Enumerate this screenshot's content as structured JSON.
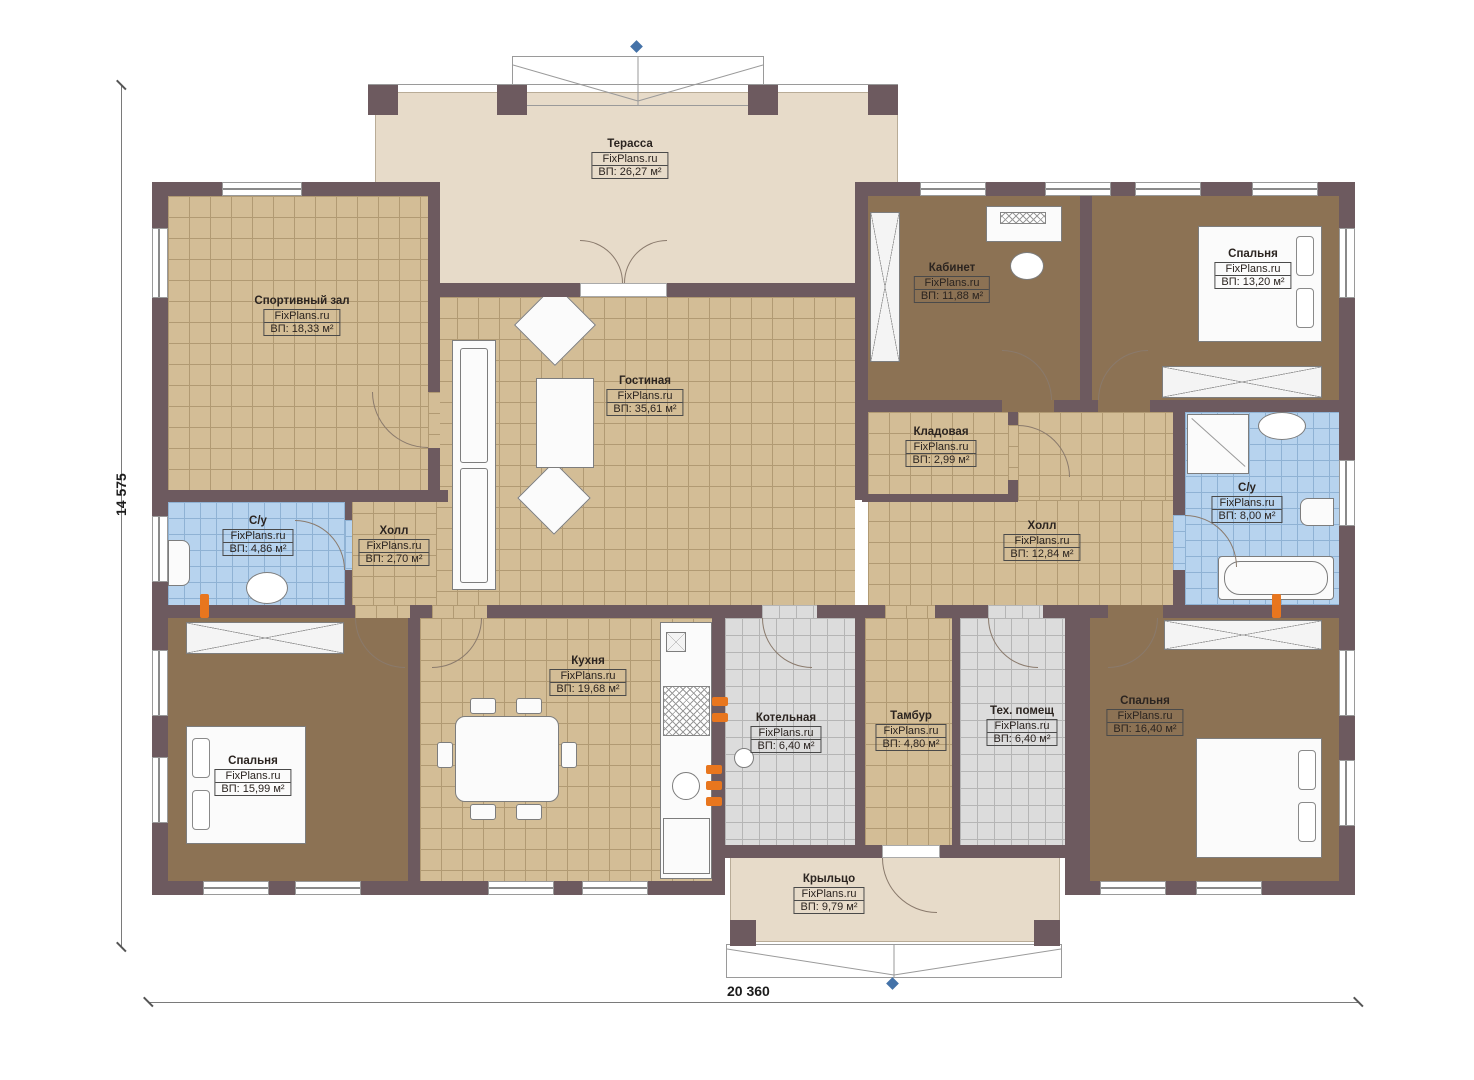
{
  "palette": {
    "wall": "#6D5A5F",
    "tan": "#D3BD96",
    "tanGrid": "#B19A73",
    "brown": "#8C7254",
    "blue": "#B7D3EE",
    "blueGrid": "#8FB2D4",
    "gray": "#DCDCDC",
    "grayGrid": "#B5B5B5",
    "beige": "#E7DBC9",
    "accent": "#E8761E",
    "marker": "#4472A8",
    "ink": "#2B2420"
  },
  "dimensions": {
    "height_label": "14 575",
    "width_label": "20 360"
  },
  "rooms": [
    {
      "id": "terrace",
      "name": "Терасса",
      "site": "FixPlans.ru",
      "area": "ВП: 26,27 м²"
    },
    {
      "id": "gym",
      "name": "Спортивный зал",
      "site": "FixPlans.ru",
      "area": "ВП: 18,33 м²"
    },
    {
      "id": "living-room",
      "name": "Гостиная",
      "site": "FixPlans.ru",
      "area": "ВП: 35,61 м²"
    },
    {
      "id": "office",
      "name": "Кабинет",
      "site": "FixPlans.ru",
      "area": "ВП: 11,88 м²"
    },
    {
      "id": "bedroom-top-right",
      "name": "Спальня",
      "site": "FixPlans.ru",
      "area": "ВП: 13,20 м²"
    },
    {
      "id": "pantry",
      "name": "Кладовая",
      "site": "FixPlans.ru",
      "area": "ВП: 2,99 м²"
    },
    {
      "id": "wc-left",
      "name": "С/у",
      "site": "FixPlans.ru",
      "area": "ВП: 4,86 м²"
    },
    {
      "id": "hall-small",
      "name": "Холл",
      "site": "FixPlans.ru",
      "area": "ВП: 2,70 м²"
    },
    {
      "id": "hall",
      "name": "Холл",
      "site": "FixPlans.ru",
      "area": "ВП: 12,84 м²"
    },
    {
      "id": "wc-right",
      "name": "С/у",
      "site": "FixPlans.ru",
      "area": "ВП: 8,00 м²"
    },
    {
      "id": "bedroom-bottom-left",
      "name": "Спальня",
      "site": "FixPlans.ru",
      "area": "ВП: 15,99 м²"
    },
    {
      "id": "kitchen",
      "name": "Кухня",
      "site": "FixPlans.ru",
      "area": "ВП: 19,68 м²"
    },
    {
      "id": "boiler-room",
      "name": "Котельная",
      "site": "FixPlans.ru",
      "area": "ВП: 6,40 м²"
    },
    {
      "id": "vestibule",
      "name": "Тамбур",
      "site": "FixPlans.ru",
      "area": "ВП: 4,80 м²"
    },
    {
      "id": "tech-room",
      "name": "Тех. помещ",
      "site": "FixPlans.ru",
      "area": "ВП: 6,40 м²"
    },
    {
      "id": "bedroom-bottom-right",
      "name": "Спальня",
      "site": "FixPlans.ru",
      "area": "ВП: 16,40 м²"
    },
    {
      "id": "porch",
      "name": "Крыльцо",
      "site": "FixPlans.ru",
      "area": "ВП: 9,79 м²"
    }
  ]
}
